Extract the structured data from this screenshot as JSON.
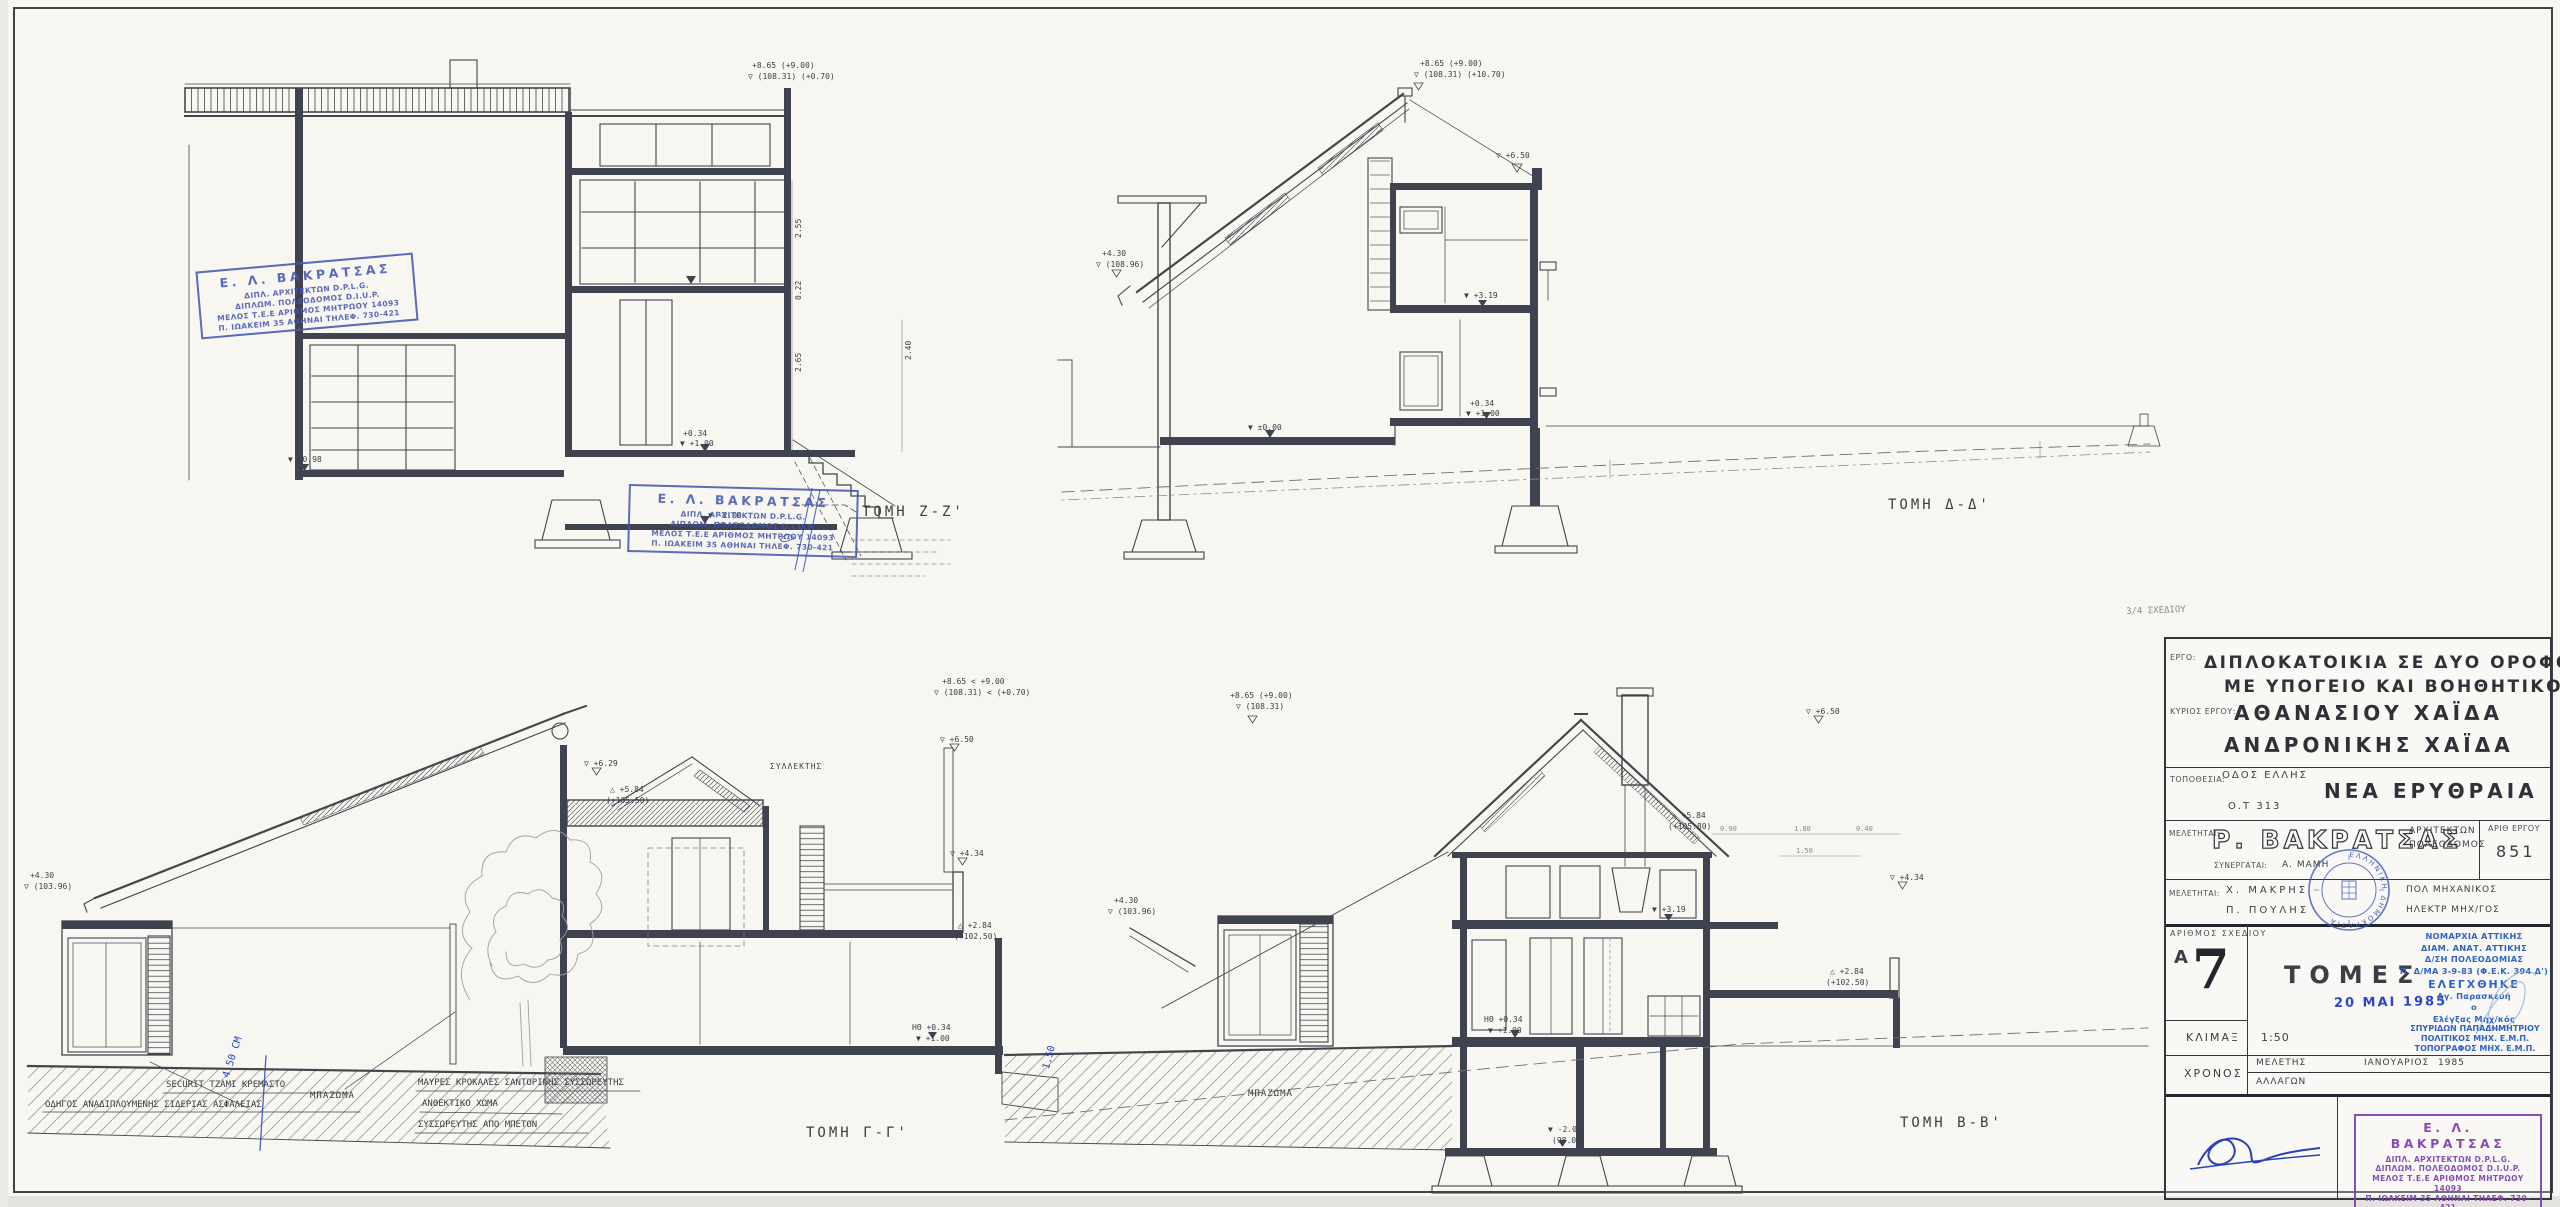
{
  "sheet": {
    "paper_color": "#f7f6f0",
    "ink_color": "#41454c",
    "pen_blue": "#2a44bb",
    "stamp_blue": "#4656b4",
    "stamp_purple": "#7d3fb2"
  },
  "title_block": {
    "labels": {
      "ergo": "ΕΡΓΟ:",
      "kyrios": "ΚΥΡΙΟΣ ΕΡΓΟΥ:",
      "topothesia": "ΤΟΠΟΘΕΣΙΑ:",
      "meletitai": "ΜΕΛΕΤΗΤΑΙ:",
      "synergatai": "ΣΥΝΕΡΓΑΤΑΙ:",
      "arith_ergou": "ΑΡΙΘ ΕΡΓΟΥ",
      "arithmos_sxediou": "ΑΡΙΘΜΟΣ ΣΧΕΔΙΟΥ",
      "klimax": "ΚΛΙΜΑΞ",
      "xronos": "ΧΡΟΝΟΣ",
      "meletis": "ΜΕΛΕΤΗΣ",
      "allagon": "ΑΛΛΑΓΩΝ"
    },
    "project_line1": "ΔΙΠΛΟΚΑΤΟΙΚΙΑ ΣΕ ΔΥΟ ΟΡΟΦΟΥΣ",
    "project_line2": "ΜΕ ΥΠΟΓΕΙΟ ΚΑΙ ΒΟΗΘΗΤΙΚΟ",
    "owner_line1": "ΑΘΑΝΑΣΙΟΥ  ΧΑΪΔΑ",
    "owner_line2": "ΑΝΔΡΟΝΙΚΗΣ  ΧΑΪΔΑ",
    "street": "ΟΔΟΣ  ΕΛΛΗΣ",
    "city_block": "Ο.Τ  313",
    "area": "ΝΕΑ  ΕΡΥΘΡΑΙΑ",
    "architect": "Ρ. ΒΑΚΡΑΤΣΑΣ",
    "architect_role1": "ΑΡΧΙΤΕΚΤΩΝ",
    "architect_role2": "ΠΟΛΕΟΔΟΜΟΣ",
    "project_no": "851",
    "collaborator": "Α. ΜΑΜΗ",
    "eng1": "Χ.  ΜΑΚΡΗΣ",
    "eng1_role": "ΠΟΛ  ΜΗΧΑΝΙΚΟΣ",
    "eng2": "Π.  ΠΟΥΛΗΣ",
    "eng2_role": "ΗΛΕΚΤΡ  ΜΗΧ/ΓΟΣ",
    "sheet_series": "Α",
    "sheet_no": "7",
    "drawing_title": "ΤΟΜΕΣ",
    "scale": "1:50",
    "study_month": "ΙΑΝΟΥΑΡΙΟΣ",
    "study_year": "1985",
    "date_stamp": "20 ΜΑΙ 1985",
    "seal_text": "ΕΛΛΗΝΙΚΗ ΔΗΜΟΚΡΑΤΙΑ",
    "pencil_note": "3/4 ΣΧΕΔΙΟΥ"
  },
  "approval": {
    "lines": [
      "ΝΟΜΑΡΧΙΑ ΑΤΤΙΚΗΣ",
      "ΔΙΑΜ. ΑΝΑΤ. ΑΤΤΙΚΗΣ",
      "Δ/ΣΗ ΠΟΛΕΟΔΟΜΙΑΣ",
      "Π. Δ/ΜΑ 3-9-83 (Φ.Ε.Κ. 394 Δ')",
      "ΕΛΕΓΧΘΗΚΕ",
      "Αγ. Παρασκευή",
      "ο",
      "Ελέγξας Μηχ/κός"
    ],
    "engineer": [
      "ΣΠΥΡΙΔΩΝ ΠΑΠΑΔΗΜΗΤΡΙΟΥ",
      "ΠΟΛΙΤΙΚΟΣ ΜΗΧ. Ε.Μ.Π.",
      "ΤΟΠΟΓΡΑΦΟΣ ΜΗΧ. Ε.Μ.Π."
    ]
  },
  "architect_stamp": {
    "lines": [
      "Ε. Λ. ΒΑΚΡΑΤΣΑΣ",
      "ΔΙΠΛ. ΑΡΧΙΤΕΚΤΩΝ D.P.L.G.",
      "ΔΙΠΛΩΜ. ΠΟΛΕΟΔΟΜΟΣ D.I.U.P.",
      "ΜΕΛΟΣ Τ.Ε.Ε ΑΡΙΘΜΟΣ ΜΗΤΡΩΟΥ 14093",
      "Π. ΙΩΑΚΕΙΜ 35 ΑΘΗΝΑΙ ΤΗΛΕΦ. 730-421"
    ]
  },
  "sections": [
    {
      "id": "zz",
      "label": "ΤΟΜΗ Ζ-Ζ'"
    },
    {
      "id": "dd",
      "label": "ΤΟΜΗ Δ-Δ'"
    },
    {
      "id": "gg",
      "label": "ΤΟΜΗ Γ-Γ'"
    },
    {
      "id": "bb",
      "label": "ΤΟΜΗ Β-Β'"
    }
  ],
  "floating_texts": [
    {
      "t": "+8.65 (+9.00)",
      "x": 752,
      "y": 62,
      "s": 8
    },
    {
      "t": "▽ (108.31) (+0.70)",
      "x": 748,
      "y": 73,
      "s": 8
    },
    {
      "t": "+0.34",
      "x": 683,
      "y": 430,
      "s": 8
    },
    {
      "t": "▼ +1.00",
      "x": 680,
      "y": 440,
      "s": 8
    },
    {
      "t": "▼ -2.00",
      "x": 708,
      "y": 512,
      "s": 8
    },
    {
      "t": "(98.00)",
      "x": 712,
      "y": 523,
      "s": 8
    },
    {
      "t": "▼ -0.98",
      "x": 288,
      "y": 456,
      "s": 8
    },
    {
      "t": "2.55",
      "x": 795,
      "y": 238,
      "s": 8,
      "r": -90
    },
    {
      "t": "0.22",
      "x": 795,
      "y": 300,
      "s": 8,
      "r": -90
    },
    {
      "t": "2.65",
      "x": 795,
      "y": 372,
      "s": 8,
      "r": -90
    },
    {
      "t": "2.40",
      "x": 905,
      "y": 360,
      "s": 8,
      "r": -90
    },
    {
      "t": "ΤΟΜΗ Ζ-Ζ'",
      "x": 862,
      "y": 505,
      "s": 14,
      "ls": 3,
      "n": "section-label-zz"
    },
    {
      "t": "+8.65 (+9.00)",
      "x": 1420,
      "y": 60,
      "s": 8
    },
    {
      "t": "▽ (108.31) (+10.70)",
      "x": 1414,
      "y": 71,
      "s": 8
    },
    {
      "t": "+4.30",
      "x": 1102,
      "y": 250,
      "s": 8
    },
    {
      "t": "▽ (108.96)",
      "x": 1096,
      "y": 261,
      "s": 8
    },
    {
      "t": "▽ +6.50",
      "x": 1496,
      "y": 152,
      "s": 8
    },
    {
      "t": "▼ +3.19",
      "x": 1464,
      "y": 292,
      "s": 8
    },
    {
      "t": "+0.34",
      "x": 1470,
      "y": 400,
      "s": 8
    },
    {
      "t": "▼ +1.00",
      "x": 1466,
      "y": 410,
      "s": 8
    },
    {
      "t": "▼ ±0.00",
      "x": 1248,
      "y": 424,
      "s": 8
    },
    {
      "t": "ΤΟΜΗ Δ-Δ'",
      "x": 1888,
      "y": 498,
      "s": 14,
      "ls": 3,
      "n": "section-label-dd"
    },
    {
      "t": "+8.65 < +9.00",
      "x": 942,
      "y": 678,
      "s": 8
    },
    {
      "t": "▽ (108.31) < (+0.70)",
      "x": 934,
      "y": 689,
      "s": 8
    },
    {
      "t": "+4.30",
      "x": 30,
      "y": 872,
      "s": 8
    },
    {
      "t": "▽ (103.96)",
      "x": 24,
      "y": 883,
      "s": 8
    },
    {
      "t": "▽ +6.29",
      "x": 584,
      "y": 760,
      "s": 8
    },
    {
      "t": "ΣΥΛΛΕΚΤΗΣ",
      "x": 770,
      "y": 763,
      "s": 8,
      "ls": 1
    },
    {
      "t": "▽ +6.50",
      "x": 940,
      "y": 736,
      "s": 8
    },
    {
      "t": "△ +5.84",
      "x": 610,
      "y": 786,
      "s": 8
    },
    {
      "t": "(+105.50)",
      "x": 606,
      "y": 797,
      "s": 8
    },
    {
      "t": "▽ +4.34",
      "x": 950,
      "y": 850,
      "s": 8
    },
    {
      "t": "△ +2.84",
      "x": 958,
      "y": 922,
      "s": 8
    },
    {
      "t": "(+102.50)",
      "x": 954,
      "y": 933,
      "s": 8
    },
    {
      "t": "ΗΘ +0.34",
      "x": 912,
      "y": 1024,
      "s": 8
    },
    {
      "t": "▼ +1.00",
      "x": 916,
      "y": 1035,
      "s": 8
    },
    {
      "t": "SECURIT ΤΖΑΜΙ ΚΡΕΜΑΣΤΟ",
      "x": 166,
      "y": 1081,
      "s": 9,
      "n": "note-securit"
    },
    {
      "t": "ΟΔΗΓΟΣ ΑΝΑΔΙΠΛΟΥΜΕΝΗΣ ΣΙΔΕΡΙΑΣ ΑΣΦΑΛΕΙΑΣ",
      "x": 45,
      "y": 1101,
      "s": 9,
      "n": "note-odigos"
    },
    {
      "t": "ΜΠΑΖΩΜΑ",
      "x": 310,
      "y": 1092,
      "s": 9,
      "ls": 1
    },
    {
      "t": "ΜΑΥΡΕΣ ΚΡΟΚΑΛΕΣ ΣΑΝΤΟΡΙΝΗΣ ΣΥΣΣΩΡΕΥΤΗΣ",
      "x": 418,
      "y": 1079,
      "s": 9
    },
    {
      "t": "ΑΝΘΕΚΤΙΚΟ ΧΩΜΑ",
      "x": 422,
      "y": 1100,
      "s": 9
    },
    {
      "t": "ΣΥΣΣΩΡΕΥΤΗΣ ΑΠΟ ΜΠΕΤΟΝ",
      "x": 418,
      "y": 1121,
      "s": 9
    },
    {
      "t": "ΤΟΜΗ Γ-Γ'",
      "x": 806,
      "y": 1126,
      "s": 14,
      "ls": 3,
      "n": "section-label-gg"
    },
    {
      "t": "4.50 CM",
      "x": 222,
      "y": 1076,
      "s": 10,
      "c": "#2a44bb",
      "r": -72,
      "n": "pen-note"
    },
    {
      "t": "+8.65 (+9.00)",
      "x": 1230,
      "y": 692,
      "s": 8
    },
    {
      "t": "▽ (108.31)",
      "x": 1236,
      "y": 703,
      "s": 8
    },
    {
      "t": "▽ +6.50",
      "x": 1806,
      "y": 708,
      "s": 8
    },
    {
      "t": "△ +5.84",
      "x": 1672,
      "y": 812,
      "s": 8
    },
    {
      "t": "(+105.80)",
      "x": 1668,
      "y": 823,
      "s": 8
    },
    {
      "t": "+4.30",
      "x": 1114,
      "y": 897,
      "s": 8
    },
    {
      "t": "▽ (103.96)",
      "x": 1108,
      "y": 908,
      "s": 8
    },
    {
      "t": "▽ +4.34",
      "x": 1890,
      "y": 874,
      "s": 8
    },
    {
      "t": "△ +2.84",
      "x": 1830,
      "y": 968,
      "s": 8
    },
    {
      "t": "(+102.50)",
      "x": 1826,
      "y": 979,
      "s": 8
    },
    {
      "t": "▼ +3.19",
      "x": 1652,
      "y": 906,
      "s": 8
    },
    {
      "t": "ΗΘ +0.34",
      "x": 1484,
      "y": 1016,
      "s": 8
    },
    {
      "t": "▼ +1.00",
      "x": 1488,
      "y": 1027,
      "s": 8
    },
    {
      "t": "▼ -2.00",
      "x": 1548,
      "y": 1126,
      "s": 8
    },
    {
      "t": "(98.00)",
      "x": 1552,
      "y": 1137,
      "s": 8
    },
    {
      "t": "ΜΠΑΖΩΜΑ",
      "x": 1248,
      "y": 1090,
      "s": 9,
      "ls": 1
    },
    {
      "t": "0.90",
      "x": 1720,
      "y": 826,
      "s": 7,
      "c": "#85878b"
    },
    {
      "t": "1.80",
      "x": 1794,
      "y": 826,
      "s": 7,
      "c": "#85878b"
    },
    {
      "t": "0.40",
      "x": 1856,
      "y": 826,
      "s": 7,
      "c": "#85878b"
    },
    {
      "t": "1.50",
      "x": 1796,
      "y": 848,
      "s": 7,
      "c": "#85878b"
    },
    {
      "t": "ΤΟΜΗ Β-Β'",
      "x": 1900,
      "y": 1116,
      "s": 14,
      "ls": 3,
      "n": "section-label-bb"
    },
    {
      "t": "1.50",
      "x": 1042,
      "y": 1068,
      "s": 10,
      "c": "#2a44bb",
      "r": -75,
      "n": "pen-note"
    },
    {
      "t": "3/4 ΣΧΕΔΙΟΥ",
      "x": 2126,
      "y": 608,
      "s": 9,
      "c": "#8b8d89",
      "r": -2,
      "n": "pencil-note"
    }
  ]
}
